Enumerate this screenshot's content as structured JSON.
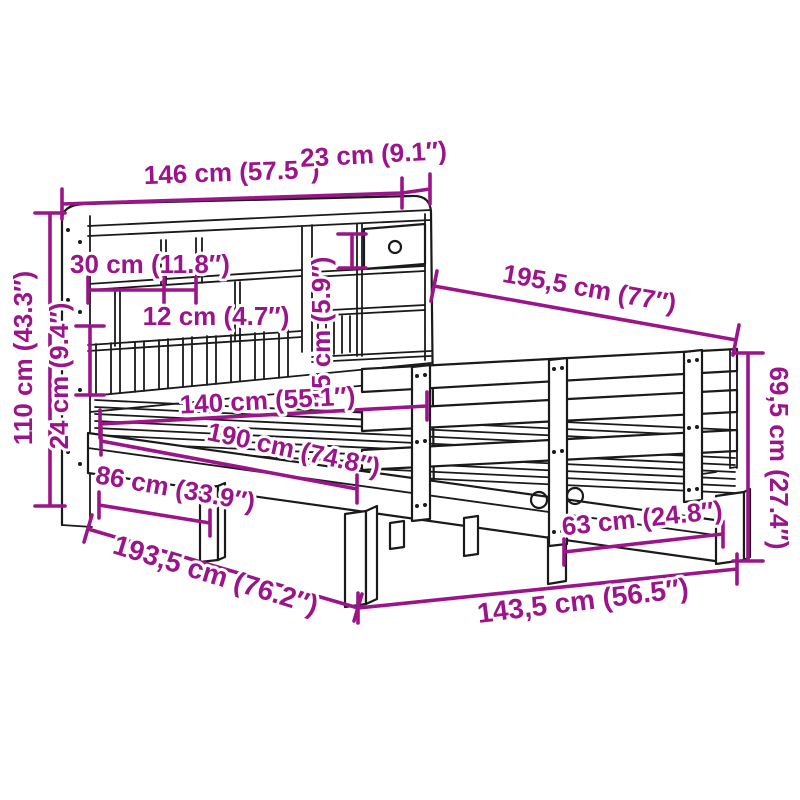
{
  "figure": {
    "kind": "product-dimension-diagram",
    "subject": "bed frame with bookcase headboard and side rail",
    "background_color": "#ffffff",
    "drawing_color": "#1a1a1a",
    "dimension_color": "#9b1489"
  },
  "dims": {
    "top_width": "146 cm (57.5″)",
    "top_depth": "23 cm (9.1″)",
    "compartment_width": "30 cm (11.8″)",
    "divider_gap": "12 cm (4.7″)",
    "drawer_height": "15 cm (5.9″)",
    "headboard_height": "110 cm (43.3″)",
    "shelf_section_height": "24 cm (9.4″)",
    "assembled_depth": "195,5 cm (77″)",
    "rail_height": "69,5 cm (27.4″)",
    "mattress_width": "140 cm (55.1″)",
    "mattress_length": "190 cm (74.8″)",
    "underbed_clearance": "86 cm (33.9″)",
    "total_length": "193,5 cm (76.2″)",
    "leg_spacing": "63 cm (24.8″)",
    "frame_width": "143,5 cm (56.5″)"
  }
}
